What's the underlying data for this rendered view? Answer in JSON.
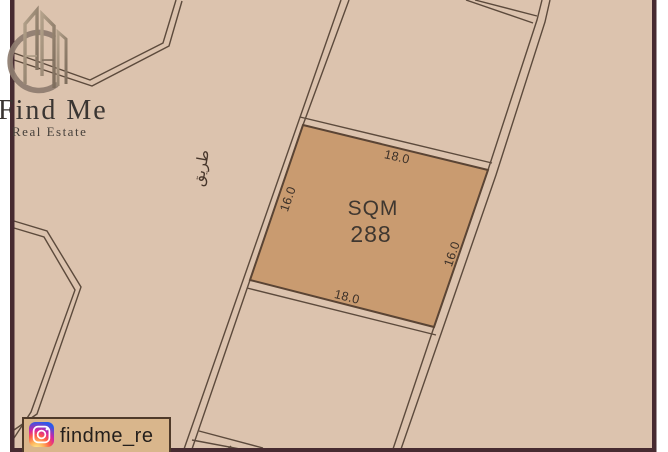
{
  "logo": {
    "title": "Find Me",
    "subtitle": "Real Estate",
    "icon": "buildings-crescent-icon"
  },
  "map": {
    "road_label_ar": "طريق",
    "parcel": {
      "area_label": "SQM",
      "area_value": "288",
      "dim_top": "18.0",
      "dim_bottom": "18.0",
      "dim_left": "16.0",
      "dim_right": "16.0"
    },
    "colors": {
      "map_bg": "#dcc3ae",
      "parcel_fill": "#c99b70",
      "parcel_stroke": "#5a4434",
      "road_line": "#5c4a3c",
      "frame": "#472b31",
      "footer_box_fill": "#d9b68c",
      "footer_box_stroke": "#4f3a2a"
    }
  },
  "footer": {
    "instagram_handle": "findme_re",
    "icon": "instagram-icon"
  }
}
